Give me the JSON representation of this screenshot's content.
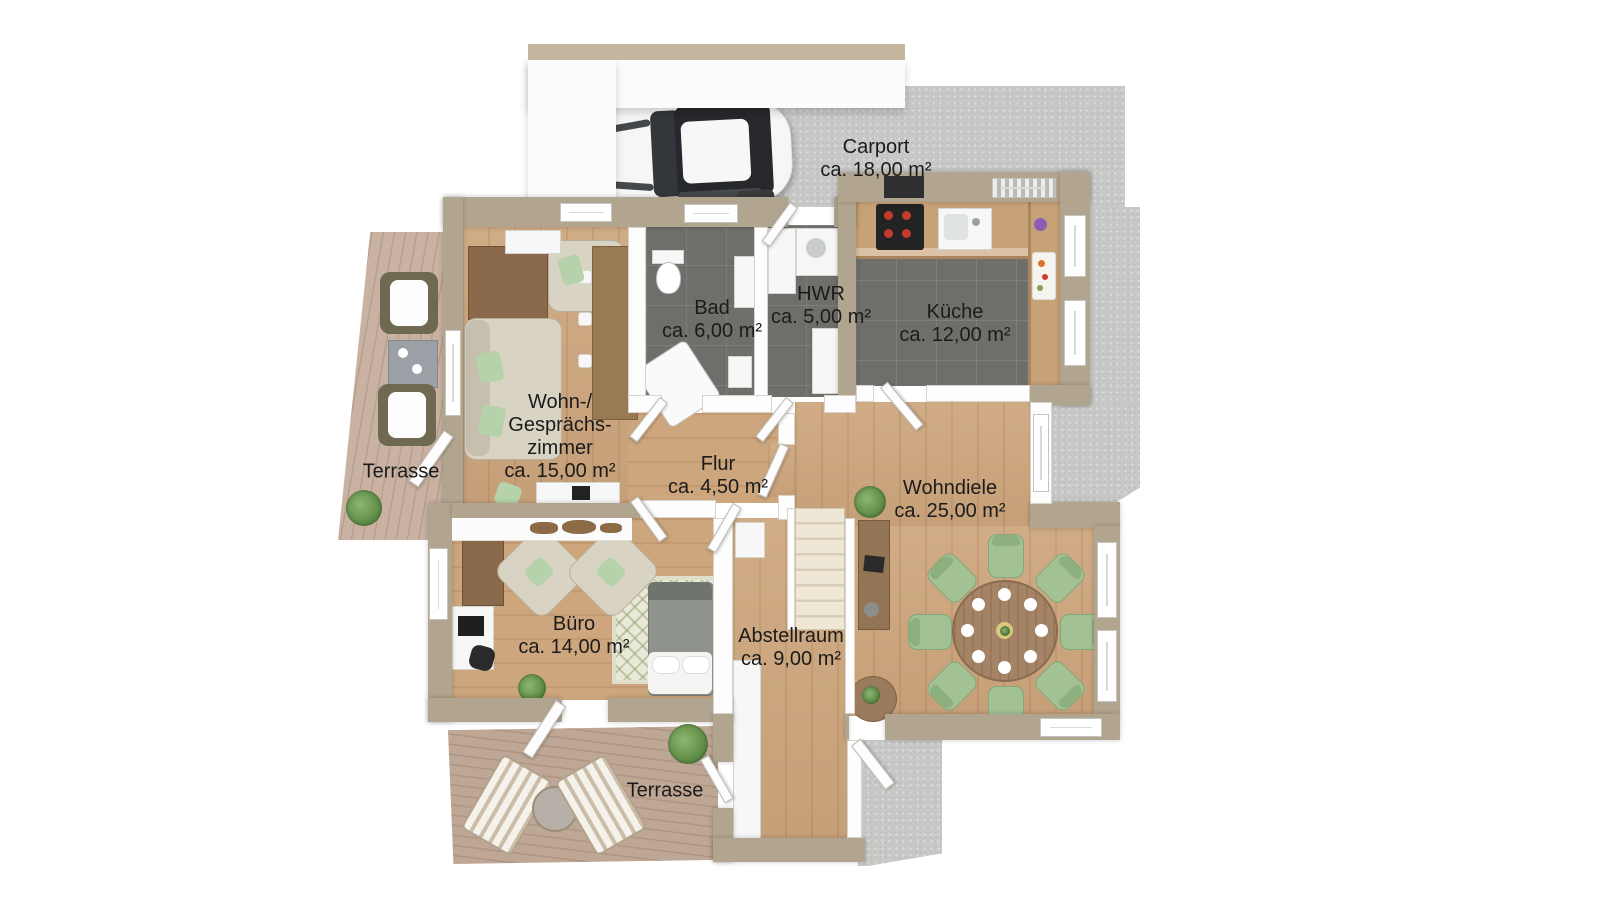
{
  "plan_type": "floor-plan-3d-top-view",
  "rooms": {
    "carport": {
      "name": "Carport",
      "area": "ca. 18,00 m²"
    },
    "bad": {
      "name": "Bad",
      "area": "ca. 6,00 m²"
    },
    "hwr": {
      "name": "HWR",
      "area": "ca. 5,00 m²"
    },
    "kueche": {
      "name": "Küche",
      "area": "ca. 12,00 m²"
    },
    "wohnzimmer": {
      "name_line1": "Wohn-/",
      "name_line2": "Gesprächs-",
      "name_line3": "zimmer",
      "area": "ca. 15,00 m²"
    },
    "flur": {
      "name": "Flur",
      "area": "ca. 4,50 m²"
    },
    "wohndiele": {
      "name": "Wohndiele",
      "area": "ca. 25,00 m²"
    },
    "buero": {
      "name": "Büro",
      "area": "ca. 14,00 m²"
    },
    "abstellraum": {
      "name": "Abstellraum",
      "area": "ca. 9,00 m²"
    },
    "terrasse_left": {
      "name": "Terrasse"
    },
    "terrasse_bottom": {
      "name": "Terrasse"
    }
  },
  "colors": {
    "wall": "#b2a58f",
    "concrete": "#c8c8c7",
    "wood_floor": "#cda67d",
    "deck": "#c9b2a1",
    "tile": "#6e6e6b",
    "chair_green": "#a2c295",
    "table_brown": "#a48366",
    "roof_band": "#c4b69e",
    "label_text": "#1b1b1b"
  }
}
